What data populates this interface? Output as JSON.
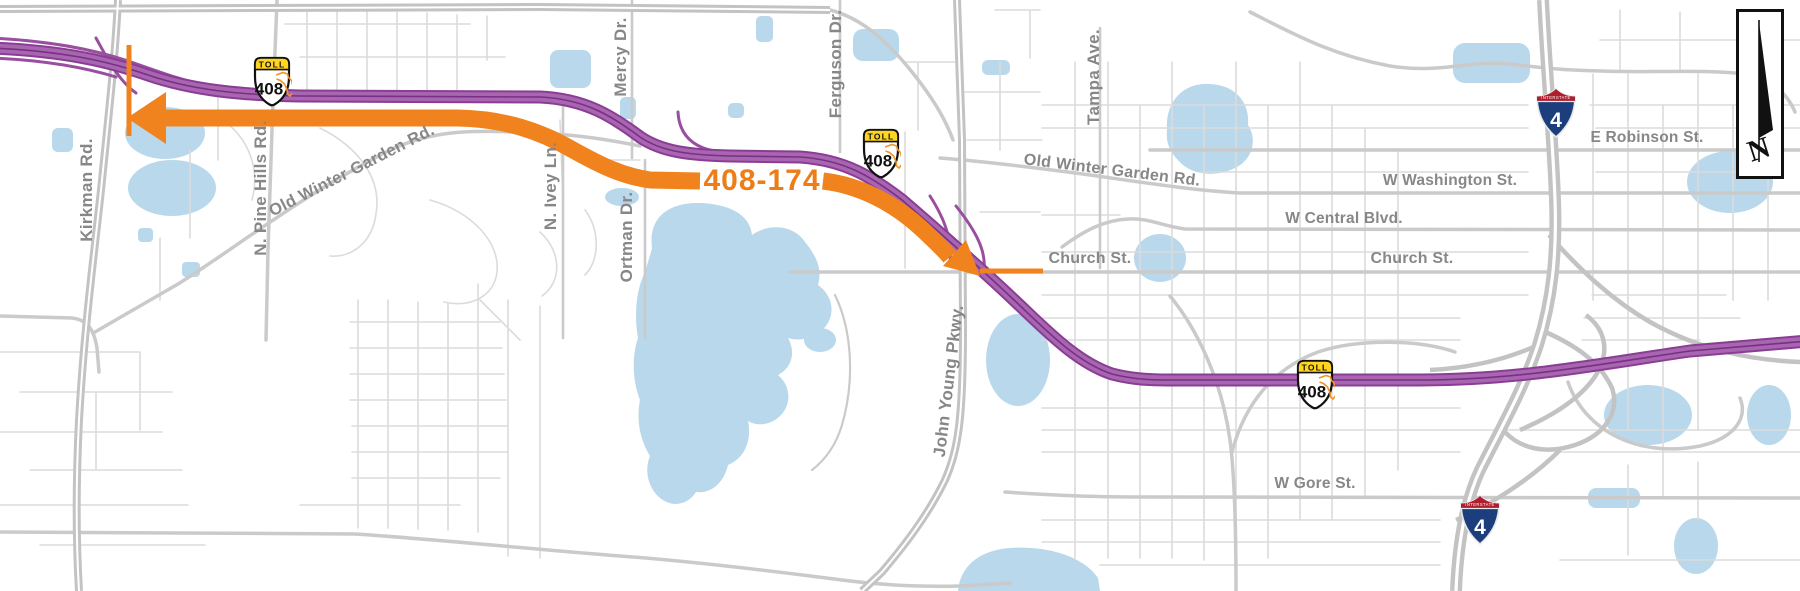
{
  "map": {
    "colors": {
      "background": "#FFFFFF",
      "water": "#B9D8EB",
      "road_thin": "#DBDBDB",
      "road_medium": "#CACACA",
      "road_major": "#C3C3C3",
      "toll_purple": "#994FA0",
      "toll_purple_dark": "#8A3D94",
      "toll_purple_light": "#A766AF",
      "route_orange": "#F0831E",
      "route_label_orange": "#ED7D17",
      "label_gray": "#878787",
      "toll_banner_yellow": "#FFD520",
      "interstate_red": "#AF1E2D",
      "interstate_blue": "#1D3E7D"
    },
    "route": {
      "label": "408-174"
    },
    "streets": {
      "kirkman": "Kirkman Rd.",
      "pine_hills": "N. Pine Hills Rd.",
      "old_winter_garden_w": "Old Winter Garden Rd.",
      "old_winter_garden_e": "Old Winter Garden Rd.",
      "ivey": "N. Ivey Ln.",
      "mercy": "Mercy Dr.",
      "ortman": "Ortman Dr.",
      "ferguson": "Ferguson Dr.",
      "tampa": "Tampa Ave.",
      "john_young": "John Young Pkwy.",
      "church_1": "Church St.",
      "church_2": "Church St.",
      "washington": "W Washington St.",
      "central": "W Central Blvd.",
      "robinson": "E Robinson St.",
      "gore": "W Gore St."
    },
    "shields": {
      "toll": {
        "banner": "TOLL",
        "number": "408"
      },
      "interstate": {
        "banner": "INTERSTATE",
        "number": "4"
      }
    },
    "compass": {
      "letter": "N"
    }
  }
}
